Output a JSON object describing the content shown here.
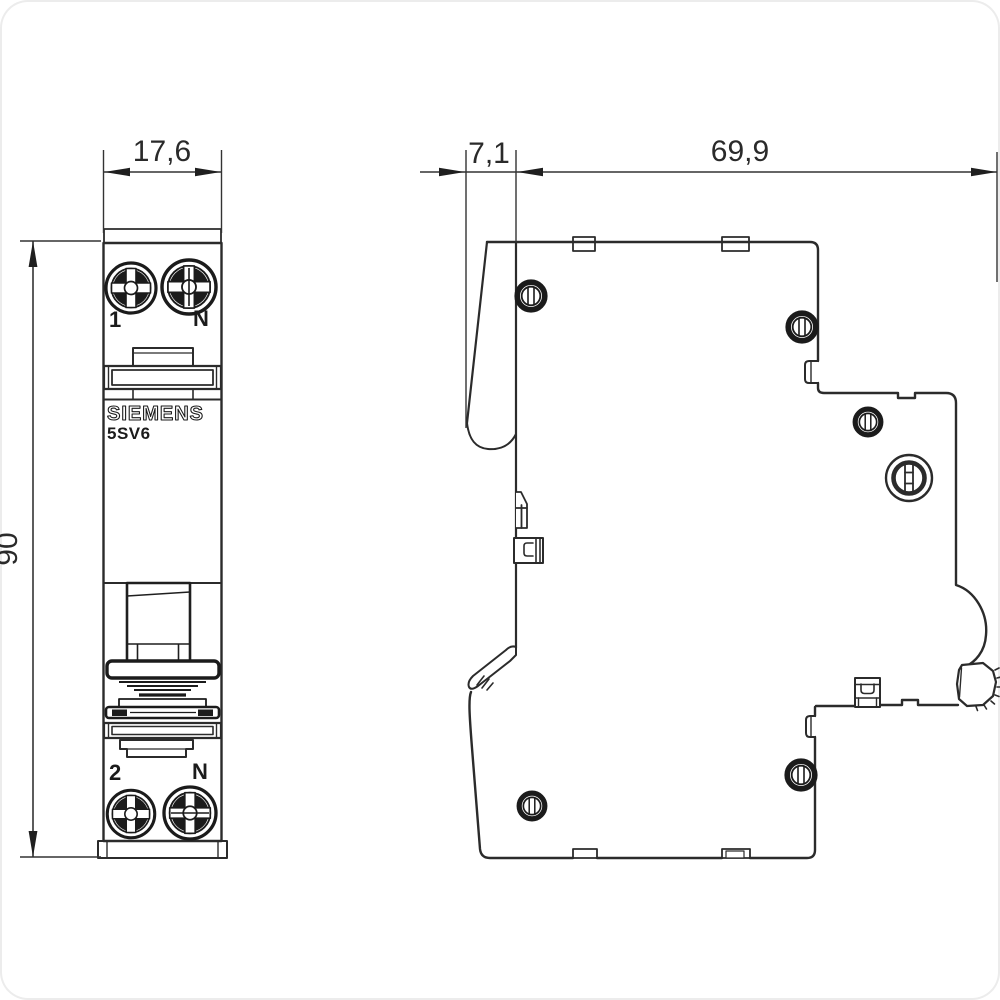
{
  "dimensions": {
    "front_width_mm": "17,6",
    "handle_depth_mm": "7,1",
    "body_depth_mm": "69,9",
    "height_mm": "90"
  },
  "front_view": {
    "terminal_top_left_label": "1",
    "terminal_top_right_label": "N",
    "brand": "SIEMENS",
    "model": "5SV6",
    "terminal_bottom_left_label": "2",
    "terminal_bottom_right_label": "N"
  },
  "colors": {
    "line": "#2b2b2b",
    "dark": "#1b1b1b",
    "background": "#ffffff"
  }
}
